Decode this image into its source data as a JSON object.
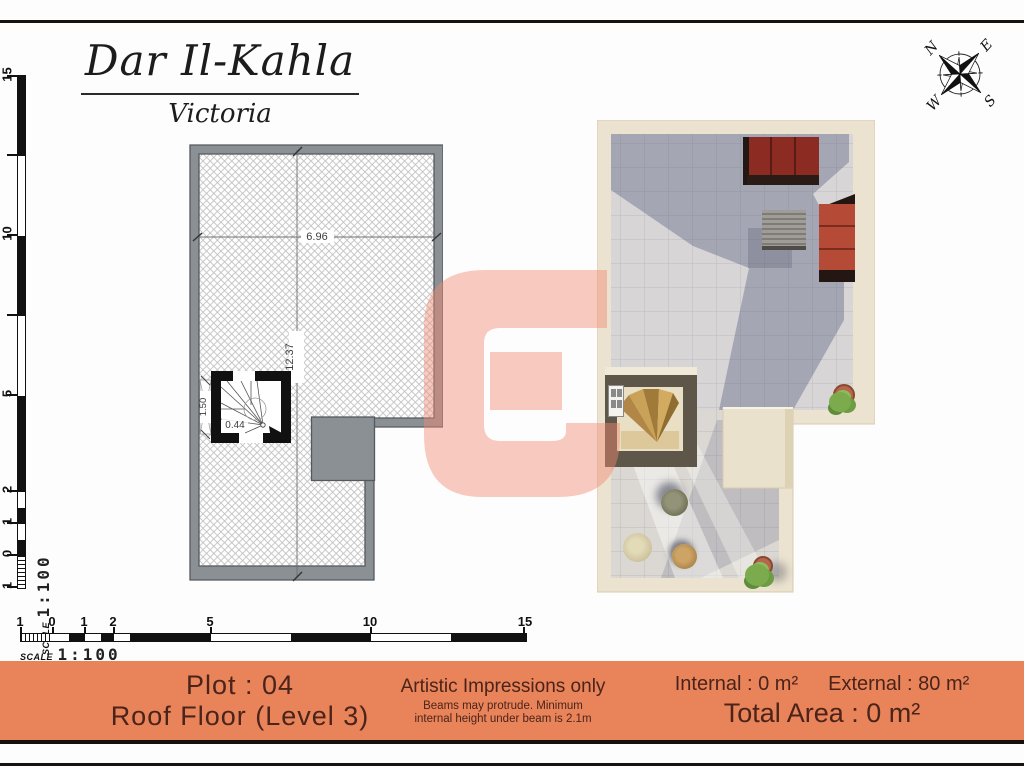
{
  "header": {
    "title": "Dar Il-Kahla",
    "subtitle": "Victoria"
  },
  "compass": {
    "north": "N",
    "east": "E",
    "south": "S",
    "west": "W"
  },
  "scale": {
    "label": "SCALE",
    "value": "1:100"
  },
  "vertical_ruler": {
    "ticks": [
      "15",
      "10",
      "5",
      "2",
      "1",
      "0",
      "1"
    ]
  },
  "horizontal_ruler": {
    "ticks": [
      "1",
      "0",
      "1",
      "2",
      "5",
      "10",
      "15"
    ]
  },
  "floor_plan": {
    "dim_width": "6.96",
    "dim_height": "12.37",
    "dim_shaft": "1.50",
    "dim_step": "0.44"
  },
  "watermark": {
    "letter": "G",
    "color": "#f28a70"
  },
  "footer": {
    "plot": "Plot : 04",
    "floor": "Roof Floor (Level 3)",
    "notice_title": "Artistic Impressions only",
    "notice_line1": "Beams may protrude. Minimum",
    "notice_line2": "internal height under beam is 2.1m",
    "internal": "Internal : 0 m²",
    "external": "External : 80 m²",
    "total": "Total Area : 0 m²"
  },
  "colors": {
    "footer_bg": "#e8835a",
    "footer_text": "#4a241a",
    "wall_gray": "#8b9094",
    "teal_marker": "#3d9a99",
    "sofa_dark_red": "#8c2b22",
    "sofa_red": "#b54a36",
    "render_wall_cream": "#ebe2cf"
  }
}
